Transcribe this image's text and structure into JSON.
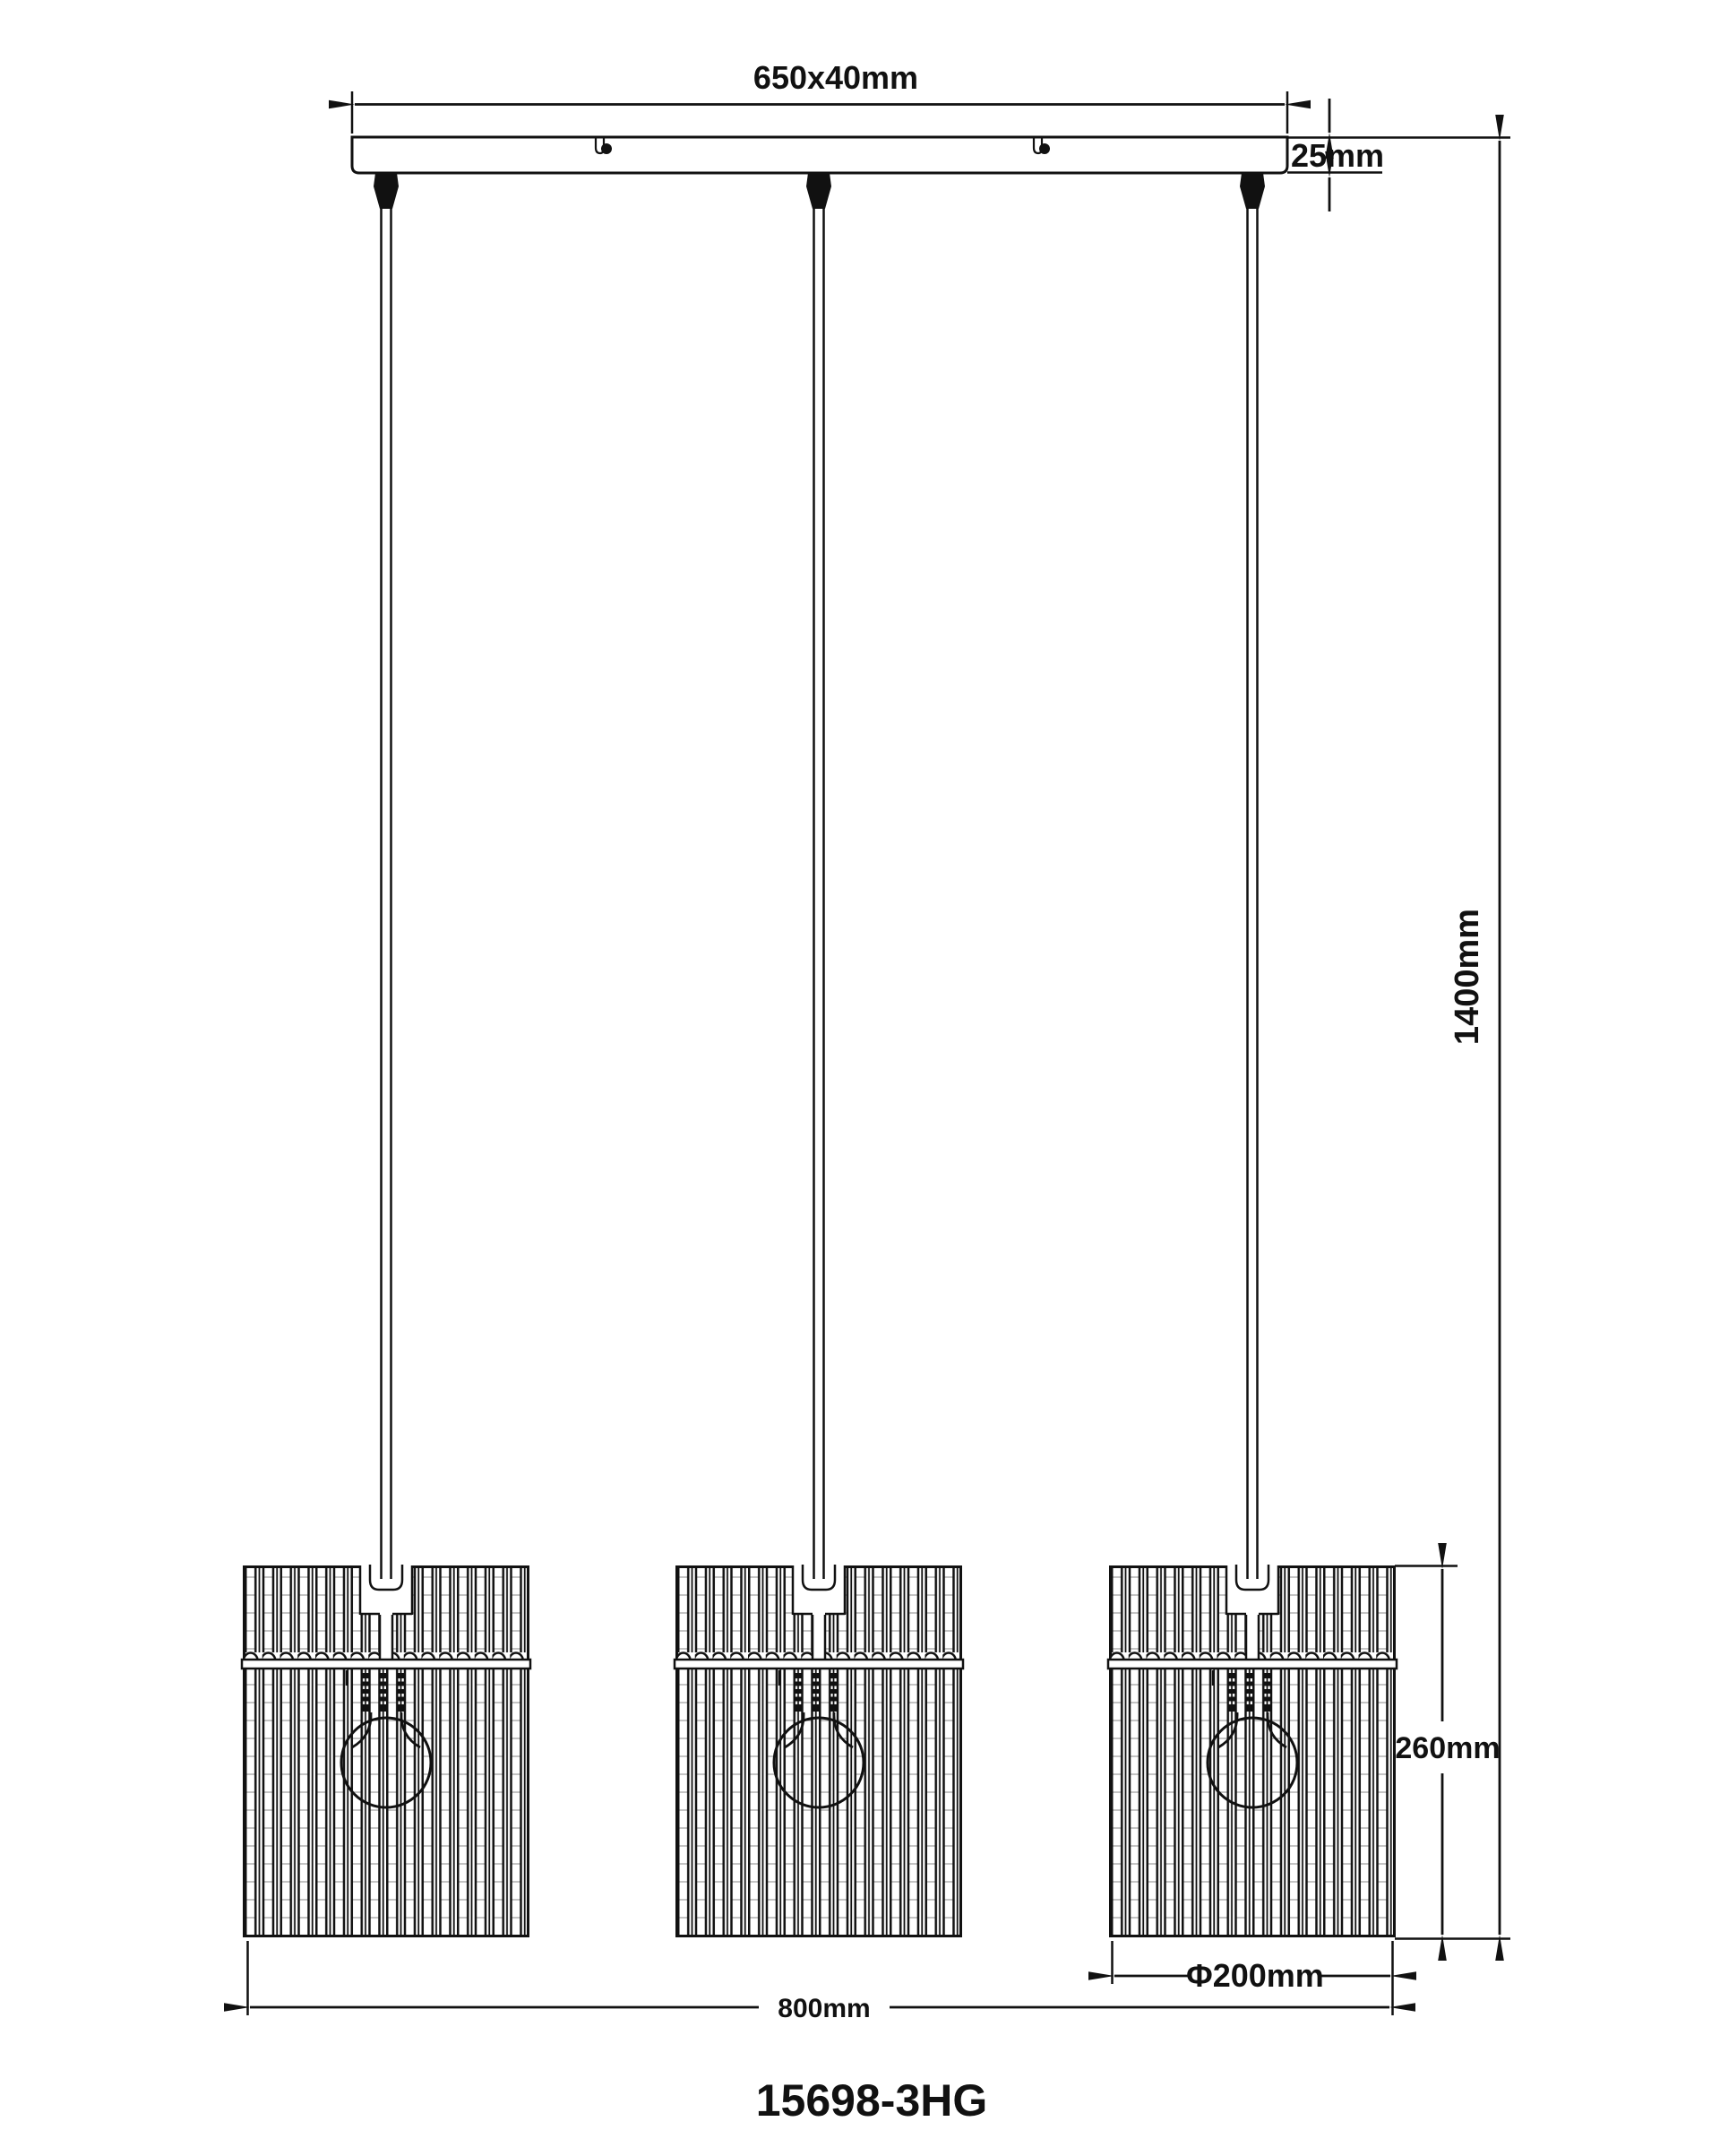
{
  "drawing": {
    "background": "#ffffff",
    "line_color": "#111111",
    "dimensions": {
      "canopy_size": "650x40mm",
      "canopy_thickness": "25mm",
      "drop_height": "1400mm",
      "shade_height": "260mm",
      "shade_diameter": "Φ200mm",
      "overall_width": "800mm"
    },
    "model_number": "15698-3HG",
    "pendant_count": 3
  }
}
